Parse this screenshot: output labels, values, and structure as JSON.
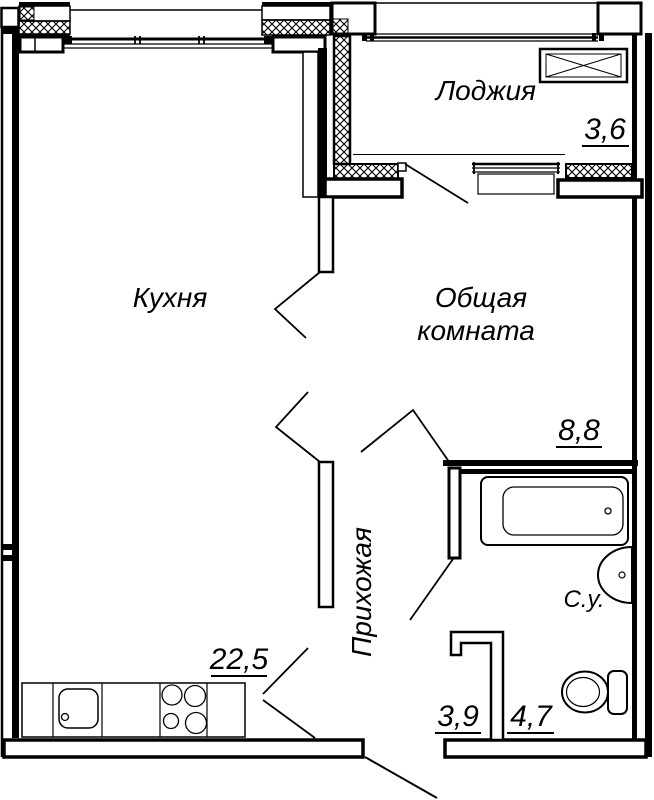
{
  "drawing": {
    "type": "apartment floor plan",
    "background_color": "#ffffff",
    "line_color": "#000000"
  },
  "rooms": {
    "kitchen": {
      "name": "Кухня",
      "area": "22,5"
    },
    "living_room": {
      "name_line1": "Общая",
      "name_line2": "комната",
      "area": "8,8"
    },
    "loggia": {
      "name": "Лоджия",
      "area": "3,6"
    },
    "hallway": {
      "name": "Прихожая",
      "area": "3,9"
    },
    "bathroom": {
      "name": "С.у.",
      "area": "4,7"
    }
  },
  "fixtures": {
    "bathtub": "bathtub-symbol",
    "washbasin": "washbasin-symbol",
    "toilet": "toilet-symbol",
    "kitchen_sink": "kitchen-sink-symbol",
    "stove": "stove-burners-symbol",
    "vent_box": "crossed-box-symbol"
  }
}
